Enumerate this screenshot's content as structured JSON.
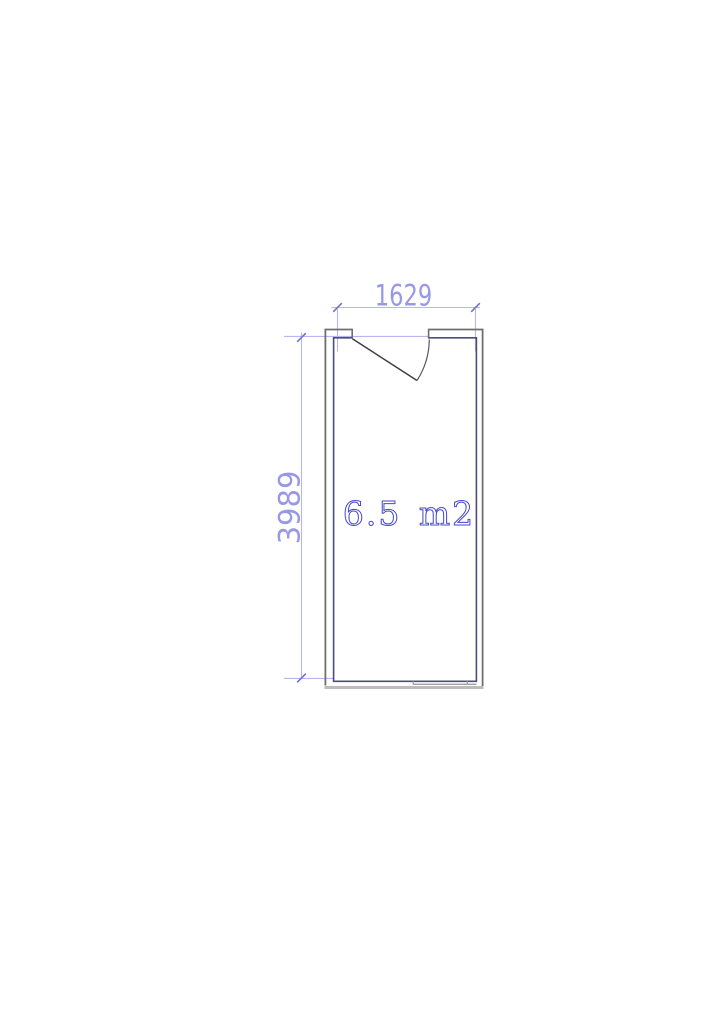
{
  "canvas": {
    "background_color": "#ffffff"
  },
  "floor_plan": {
    "room": {
      "area_label": "6.5 m2",
      "area_label_color": "#4646cf"
    },
    "dimensions": {
      "width_mm": "1629",
      "height_mm": "3989"
    },
    "palette": {
      "dimension_line": "#b6b6f0",
      "dimension_tick": "#7070d0",
      "dimension_text": "#9898e6",
      "wall_outer": "#6f6f6f",
      "wall_inner": "#4d4d79",
      "wall_bottom_outer": "#bcbcbc",
      "wall_sill": "#a0a0a0",
      "door_leaf": "#3f3f3f",
      "door_arc": "#5a5a5a"
    }
  }
}
